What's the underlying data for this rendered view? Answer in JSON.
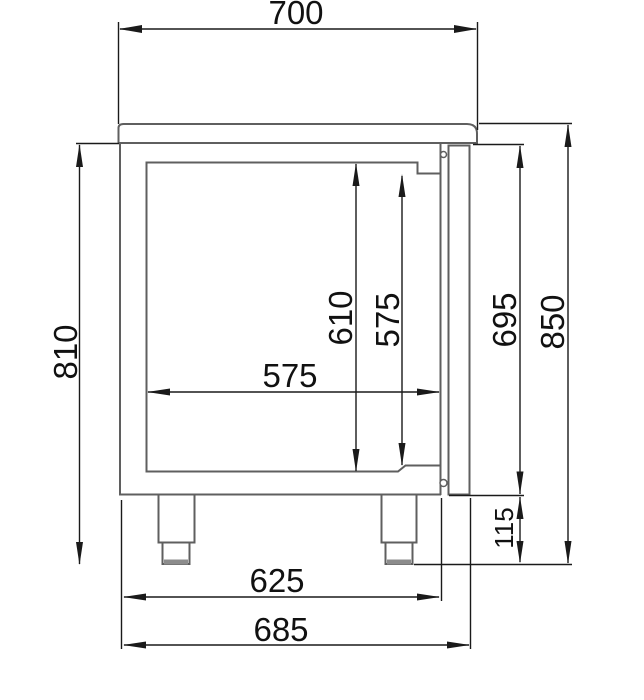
{
  "drawing": {
    "type": "technical-dimension-drawing",
    "view": "side-section-of-counter-cabinet-with-door-and-feet",
    "colors": {
      "object_line": "#5f5f5f",
      "dimension_line": "#1a1a1a",
      "background": "#ffffff",
      "foot_pad": "#8c8c8c"
    },
    "dimensions": {
      "top_width": "700",
      "body_height_left": "810",
      "interior_height": "610",
      "opening_height": "575",
      "interior_depth": "575",
      "front_height": "695",
      "total_height": "850",
      "leg_height": "115",
      "body_depth": "625",
      "total_depth": "685"
    }
  }
}
